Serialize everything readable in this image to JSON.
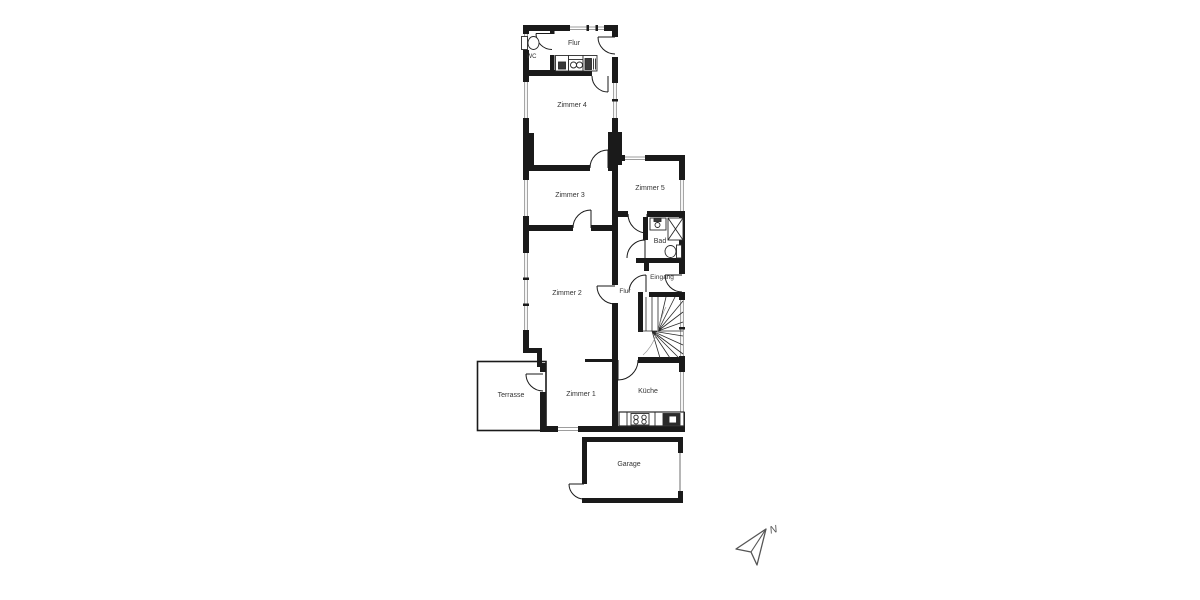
{
  "floorplan": {
    "colors": {
      "background": "#ffffff",
      "wall": "#1a1a1a",
      "window_glass": "#9d9d9d",
      "door_swing": "#1a1a1a",
      "fixture": "#2a2a2a",
      "label": "#333333",
      "compass": "#555555"
    },
    "rooms": {
      "wc": "WC",
      "flur_top": "Flur",
      "zimmer4": "Zimmer 4",
      "zimmer3": "Zimmer 3",
      "zimmer5": "Zimmer 5",
      "bad": "Bad",
      "eingang": "Eingang",
      "flur_mid": "Flur",
      "zimmer2": "Zimmer 2",
      "zimmer1": "Zimmer 1",
      "terrasse": "Terrasse",
      "kueche": "Küche",
      "garage": "Garage"
    },
    "compass": {
      "north_label": "N"
    },
    "fixtures": {
      "wc": [
        "toilet-icon",
        "washbasin-icon"
      ],
      "hall": [
        "washing-machine-icon",
        "dryer-icon"
      ],
      "bad": [
        "washbasin-icon",
        "shower-icon",
        "toilet-icon"
      ],
      "kueche": [
        "stove-icon",
        "kitchen-sink-icon"
      ],
      "stairwell": [
        "winder-staircase-icon"
      ],
      "compass": [
        "north-arrow-icon"
      ]
    }
  }
}
